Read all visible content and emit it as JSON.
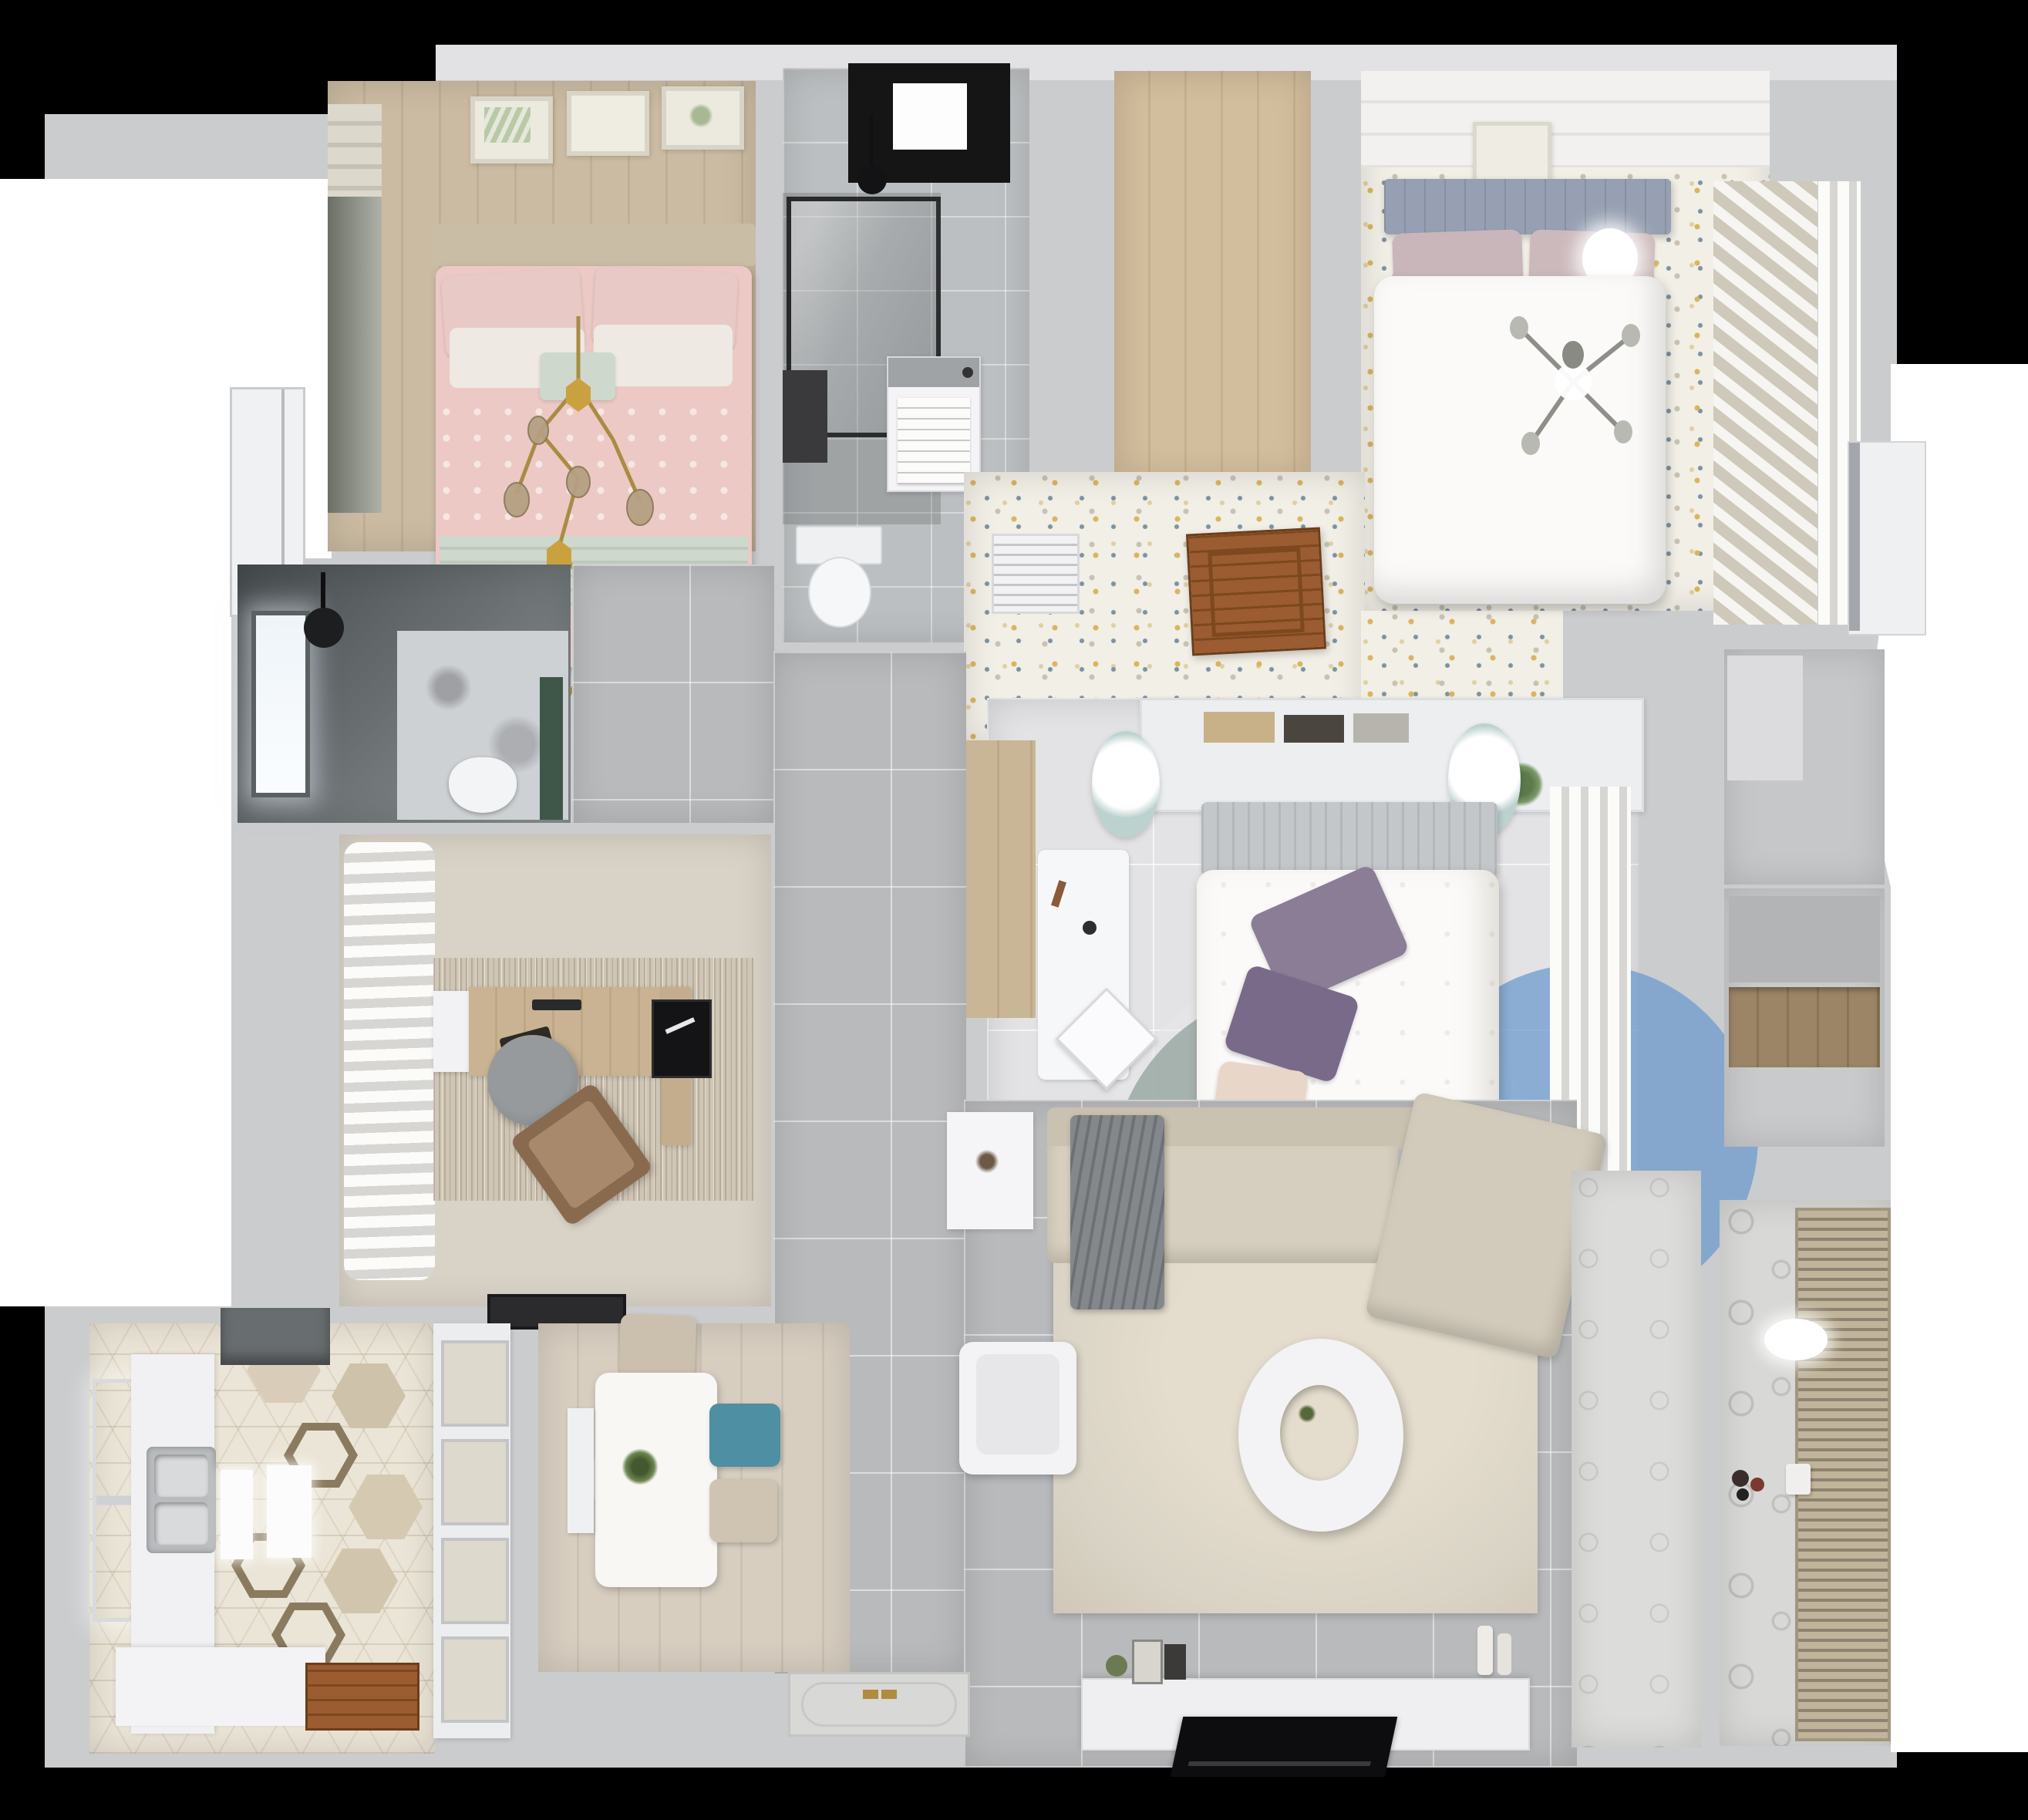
{
  "scene": {
    "description": "Top-down 3D render of a furnished two-bedroom apartment floor plan on a black background",
    "view": "top-down interior render",
    "background": "#000000"
  },
  "palette": {
    "bg": "#000000",
    "mask": "#ffffff",
    "wall": "#cbccce",
    "wallLight": "#e2e2e4",
    "wallShadow": "#b3b4b6",
    "tileGray": "#b9babc",
    "tileBath": "#bcbfc1",
    "paleFloor": "#e3e3e5",
    "woodPink1": "#cbbba2",
    "woodPink2": "#c0af94",
    "woodCloset1": "#d2bd9c",
    "woodCloset2": "#c6b08e",
    "woodDining1": "#d7cec0",
    "woodDining2": "#ccc2b2",
    "woodStrip": "#c9b696",
    "woodShelf": "#9b8566",
    "woodDoor": "#9a5c30",
    "floralBase": "#f2efe7",
    "dotGold": "#d9b55f",
    "dotSlate": "#7d92a3",
    "dotGray": "#c8c2b2",
    "kitchenFloor": "#ebe5d7",
    "balconyFloor": "#d8d8d6",
    "entryFloor": "#dcdcda",
    "studyFloor": "#d9d3c7",
    "rugStudy1": "#cfc6b5",
    "rugLiving": "#d9d3c5",
    "sofa": "#d6cfbf",
    "sofaBack": "#c9c2b1",
    "blanket": "#85888b",
    "teal": "#4e8fa3",
    "chairBeige": "#cbc0ae",
    "bedWhite": "#fbfaf8",
    "headboardSlate": "#96a0b2",
    "pillowMauve": "#c8b6ba",
    "headboardGray": "#c3c7c9",
    "pillowPurple": "#8a7d95",
    "pillowPurple2": "#796a8a",
    "pillowPeach": "#e8d6c8",
    "pinkDuvet": "#ecc9c4",
    "pinkPillow": "#e8c9c6",
    "whitePillow": "#eee9e2",
    "mint": "#cfd8cc",
    "rugTealC": "#96a5a0cc",
    "rugMauveC": "#8c7382b3",
    "rugBlueC": "#6e9bcdbf",
    "rugPaleC": "#e6e6e888",
    "gold": "#a98c44",
    "goldGlass": "#b5a083",
    "dark": "#17171a",
    "skyBlack": "#151515",
    "steel": "#b9bcbe",
    "steelDark": "#9fa3a6",
    "hood": "#686d70",
    "white": "#f4f4f6",
    "green": "#5d7a4a",
    "greenDark": "#3f5748",
    "marble": "#ced1d3",
    "rack1": "#c0b49a",
    "rack2": "#8e8370",
    "curtain1": "#fbfbfa",
    "curtain2": "#d7d6d2",
    "slat1": "#f6f5f1",
    "slat2": "#cfc9bb",
    "chairGray": "#8e9294",
    "lounge": "#8a6a4e",
    "brass": "#b08c3e"
  },
  "rooms": [
    {
      "id": "bedroom-pink",
      "name": "Bedroom (pink)",
      "floor": "light wood planks",
      "furniture": [
        "double bed with pink bedding",
        "mint throw blanket",
        "pink and white pillows",
        "gold branch chandelier",
        "three wall art frames",
        "window with roman shade"
      ]
    },
    {
      "id": "bathroom-top",
      "name": "Bathroom",
      "floor": "gray tile",
      "furniture": [
        "glass shower enclosure",
        "black skylight window",
        "black pendant lamp",
        "washing machine with manual",
        "toilet"
      ]
    },
    {
      "id": "closet-room",
      "name": "Walk-in closet",
      "floor": "oak planks",
      "furniture": []
    },
    {
      "id": "master-bedroom",
      "name": "Master bedroom",
      "floor": "speckled floral carpet",
      "furniture": [
        "double bed with white duvet",
        "slate tufted headboard",
        "mauve pillows",
        "gray sputnik chandelier",
        "slatted wardrobe",
        "sheer curtains",
        "wall art frame",
        "potted plant"
      ]
    },
    {
      "id": "vestibule",
      "name": "Vestibule corridor",
      "floor": "speckled floral carpet",
      "furniture": [
        "air vent grille",
        "open wooden door"
      ]
    },
    {
      "id": "bedroom-center",
      "name": "Bedroom (center)",
      "floor": "pale stone tile",
      "furniture": [
        "bed with floral duvet",
        "purple pillows",
        "headboard shelf with books",
        "two mint pendant poufs",
        "white desk and chair",
        "round color-block rug",
        "sheer curtains",
        "low cabinet"
      ]
    },
    {
      "id": "study",
      "name": "Study",
      "floor": "beige screed",
      "furniture": [
        "wooden desk",
        "monitor",
        "black art frame",
        "gray swivel chair",
        "brown lounge chair",
        "textured area rug",
        "white sideboard",
        "wavy sheer curtains",
        "dark doormat"
      ]
    },
    {
      "id": "bathroom-dark",
      "name": "Shower room",
      "floor": "dark slate",
      "furniture": [
        "bright window",
        "black rain shower head",
        "marble feature wall",
        "green accent panel",
        "toilet"
      ]
    },
    {
      "id": "kitchen",
      "name": "Kitchen",
      "floor": "patterned hex tile",
      "furniture": [
        "double stainless sink",
        "white counters",
        "range hood",
        "two serving boards",
        "wooden door",
        "window"
      ]
    },
    {
      "id": "dining",
      "name": "Dining room",
      "floor": "wood planks",
      "furniture": [
        "white dining table",
        "plant centerpiece",
        "teal chair",
        "two beige chairs",
        "white bench",
        "round layered rug",
        "glass-front cabinet"
      ]
    },
    {
      "id": "living",
      "name": "Living room",
      "floor": "gray tile",
      "furniture": [
        "L-shaped beige sofa",
        "gray throw blanket",
        "round two-tier coffee table",
        "white armchair",
        "white side table",
        "TV console with decor",
        "flat TV",
        "large beige rug"
      ]
    },
    {
      "id": "entry",
      "name": "Entry hall",
      "floor": "patterned tile",
      "furniture": [
        "embossed front door with brass handles"
      ]
    },
    {
      "id": "balcony",
      "name": "Balcony laundry",
      "floor": "patterned tile",
      "furniture": [
        "drying rack blinds",
        "ceiling light",
        "floor toys",
        "watering can"
      ]
    },
    {
      "id": "closet-nook",
      "name": "Storage nook",
      "floor": "gray",
      "furniture": [
        "wooden shelf"
      ]
    },
    {
      "id": "hall-right",
      "name": "Right hallway",
      "floor": "gray",
      "furniture": [
        "white entry door",
        "side door"
      ]
    }
  ]
}
